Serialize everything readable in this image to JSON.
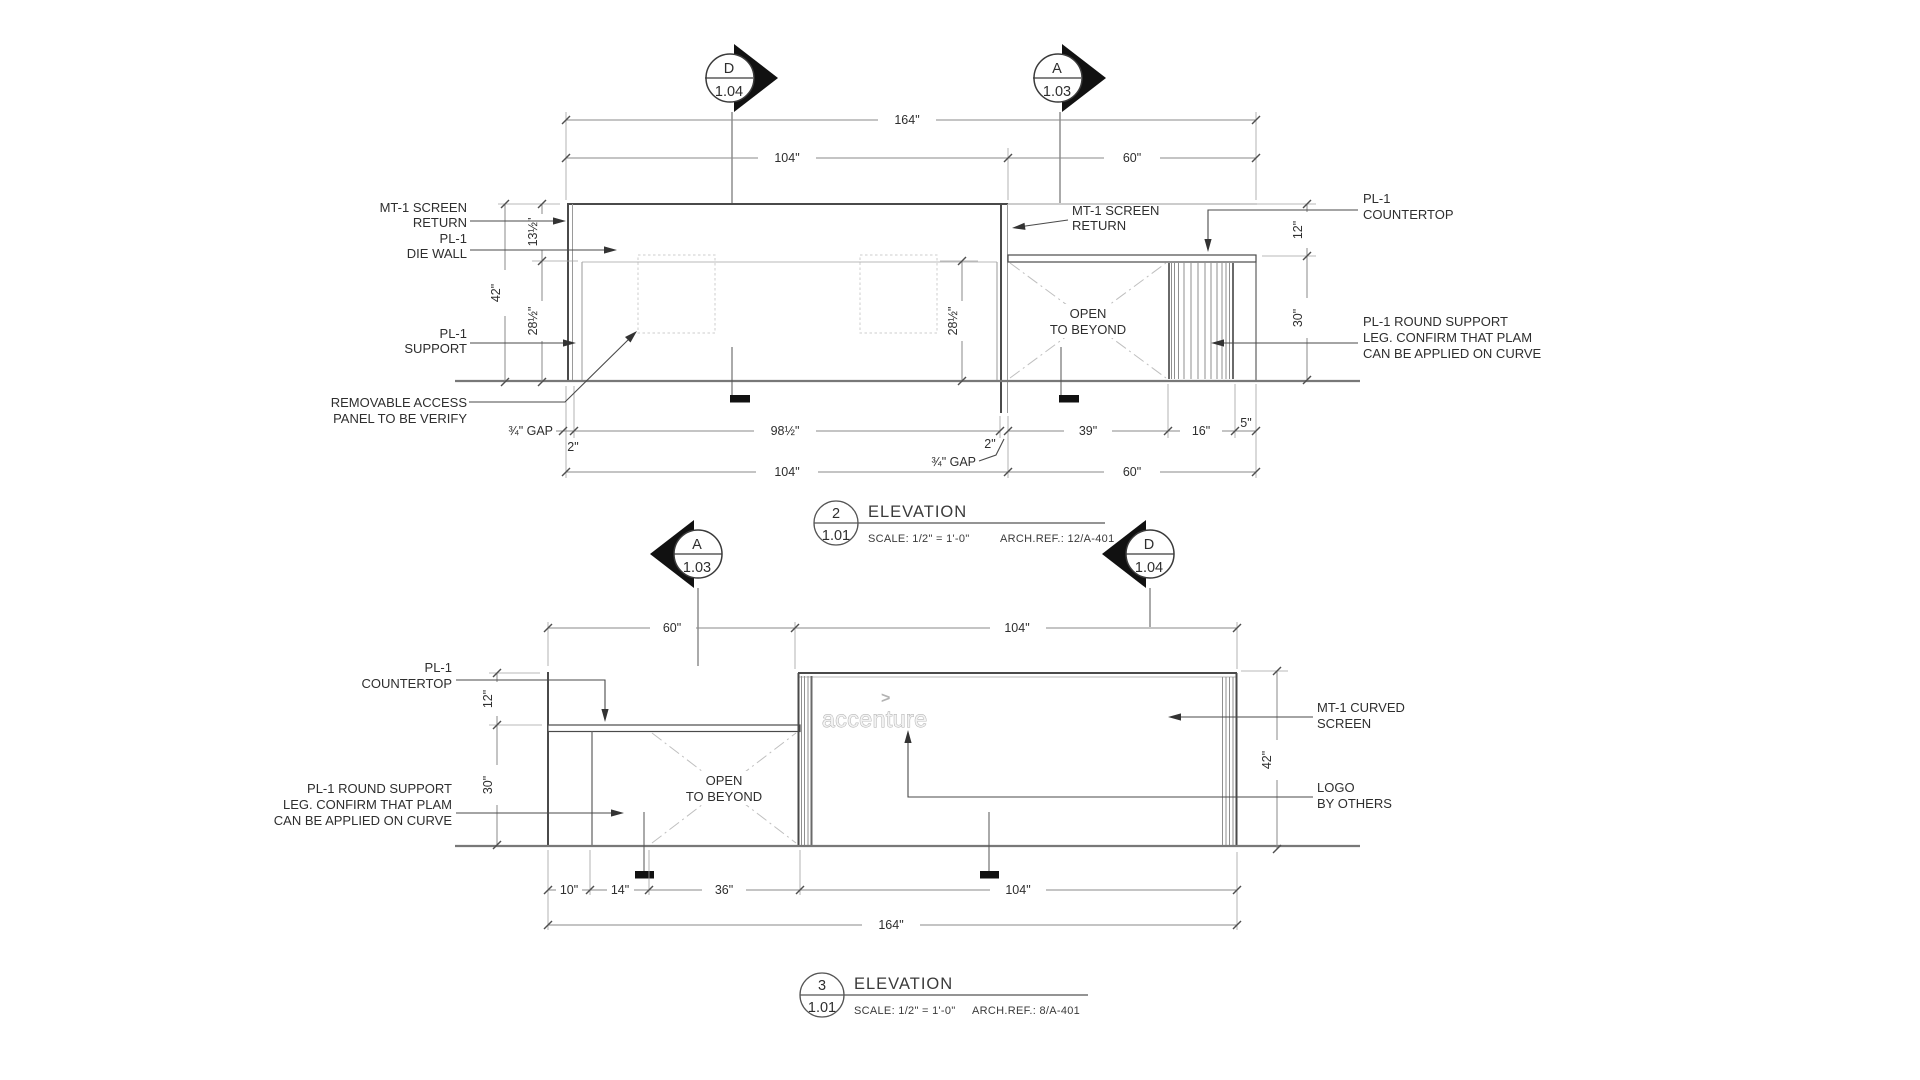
{
  "e2": {
    "marker_left": {
      "letter": "D",
      "num": "1.04"
    },
    "marker_right": {
      "letter": "A",
      "num": "1.03"
    },
    "dim_total": "164\"",
    "dim_left": "104\"",
    "dim_right": "60\"",
    "dim_h42": "42\"",
    "dim_h13": "13½\"",
    "dim_h28a": "28½\"",
    "dim_h28b": "28½\"",
    "dim_v12": "12\"",
    "dim_v30": "30\"",
    "gap_l": "¾\" GAP",
    "two_l": "2\"",
    "dim_98": "98½\"",
    "two_r": "2\"",
    "gap_r": "¾\" GAP",
    "dim_39": "39\"",
    "dim_16": "16\"",
    "dim_5": "5\"",
    "dimb_left": "104\"",
    "dimb_right": "60\"",
    "lbl_screen1": "MT-1 SCREEN",
    "lbl_screen2": "RETURN",
    "lbl_die1": "PL-1",
    "lbl_die2": "DIE WALL",
    "lbl_support1": "PL-1",
    "lbl_support2": "SUPPORT",
    "lbl_removable1": "REMOVABLE ACCESS",
    "lbl_removable2": "PANEL TO BE VERIFY",
    "lbl_screen_mid1": "MT-1 SCREEN",
    "lbl_screen_mid2": "RETURN",
    "lbl_ct1": "PL-1",
    "lbl_ct2": "COUNTERTOP",
    "lbl_round1": "PL-1 ROUND SUPPORT",
    "lbl_round2": "LEG. CONFIRM THAT PLAM",
    "lbl_round3": "CAN BE APPLIED ON CURVE",
    "open1": "OPEN",
    "open2": "TO BEYOND",
    "title_num": "2",
    "title_sheet": "1.01",
    "title_name": "ELEVATION",
    "title_scale": "SCALE: 1/2\" = 1'-0\"",
    "title_ref": "ARCH.REF.: 12/A-401"
  },
  "e3": {
    "marker_left": {
      "letter": "A",
      "num": "1.03"
    },
    "marker_right": {
      "letter": "D",
      "num": "1.04"
    },
    "dim_left": "60\"",
    "dim_right": "104\"",
    "dim_v12": "12\"",
    "dim_v30": "30\"",
    "dim_h42": "42\"",
    "lbl_ct1": "PL-1",
    "lbl_ct2": "COUNTERTOP",
    "lbl_round1": "PL-1 ROUND SUPPORT",
    "lbl_round2": "LEG. CONFIRM THAT PLAM",
    "lbl_round3": "CAN BE APPLIED ON CURVE",
    "lbl_curved1": "MT-1 CURVED",
    "lbl_curved2": "SCREEN",
    "lbl_logo1": "LOGO",
    "lbl_logo2": "BY OTHERS",
    "open1": "OPEN",
    "open2": "TO BEYOND",
    "logo_chevron": ">",
    "logo_text": "accenture",
    "dim_10": "10\"",
    "dim_14": "14\"",
    "dim_36": "36\"",
    "dim_104": "104\"",
    "dim_total": "164\"",
    "title_num": "3",
    "title_sheet": "1.01",
    "title_name": "ELEVATION",
    "title_scale": "SCALE: 1/2\" = 1'-0\"",
    "title_ref": "ARCH.REF.: 8/A-401"
  }
}
